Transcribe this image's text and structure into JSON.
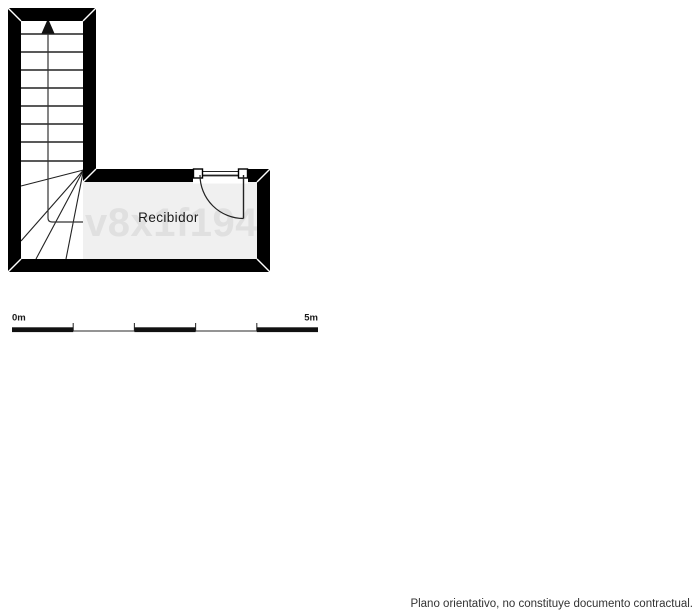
{
  "plan": {
    "room_label": "Recibidor",
    "watermark": "v8x1f194"
  },
  "scale_bar": {
    "start_label": "0m",
    "end_label": "5m"
  },
  "footer": {
    "disclaimer": "Plano orientativo, no constituye documento contractual."
  },
  "colors": {
    "wall": "#000000",
    "room_fill": "#f0f0f0",
    "stair_fill": "#ffffff",
    "watermark": "#e0e0e0",
    "line": "#222222"
  }
}
